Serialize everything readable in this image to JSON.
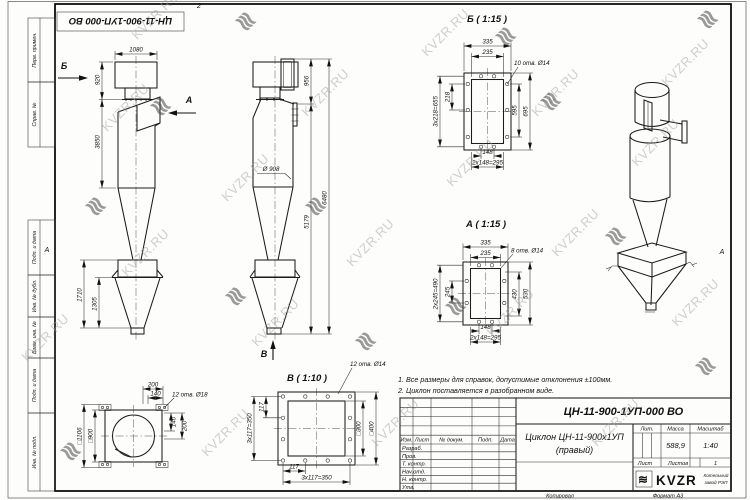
{
  "sheet": {
    "designation_rotated": "ЦН-11-900-1УП-000 ВО",
    "fold_top": "2",
    "fold_left": "А",
    "fold_right": "А",
    "margin_labels": [
      "Перв. примен.",
      "Справ. №",
      "Подп. и дата",
      "Инв. № дубл.",
      "Взам. инв. №",
      "Подп. и дата",
      "Инв. № подл."
    ]
  },
  "watermark": {
    "text": "KVZR.RU",
    "logo_glyph": "≋"
  },
  "views": {
    "side": {
      "arrow_b": "Б",
      "arrow_a": "А",
      "dim_top_width": "1080",
      "dim_outlet_h": "920",
      "dim_body_h": "3850",
      "dim_bottom_h": "1710",
      "dim_hopper_h": "1305"
    },
    "front": {
      "arrow_v": "В",
      "dim_inlet_h": "956",
      "dim_total_h": "6480",
      "dim_lower_h": "5179",
      "dim_diameter": "Ø 908"
    },
    "detail_b": {
      "title": "Б ( 1:15 )",
      "holes_note": "10 отв. Ø14",
      "dim_335": "335",
      "dim_235": "235",
      "dim_218": "218",
      "chain_left": "3х218=655",
      "dim_595": "595",
      "dim_695": "695",
      "dim_148": "148",
      "chain_bottom": "2х148=295"
    },
    "detail_a": {
      "title": "А ( 1:15 )",
      "holes_note": "8 отв. Ø14",
      "dim_335": "335",
      "dim_235": "235",
      "dim_245": "245",
      "chain_left": "2х245=490",
      "dim_430": "430",
      "dim_530": "530",
      "dim_148": "148",
      "chain_bottom": "2х148=295"
    },
    "detail_v": {
      "title": "В ( 1:10 )",
      "holes_note": "12 отв. Ø14",
      "dim_117_left": "117",
      "chain_left": "3х117=350",
      "dim_117_bottom": "117",
      "chain_bottom": "3х117=350",
      "dim_sq300": "□300",
      "dim_sq400": "□400"
    },
    "plan": {
      "holes_note": "12 отв. Ø18",
      "dim_200_top": "200",
      "dim_140_top": "140",
      "dim_sq1106": "□1106",
      "dim_sq900": "□900",
      "dim_140_right": "140",
      "dim_200_right": "200"
    }
  },
  "notes": {
    "line1": "1. Все размеры для справок, допустимые отклонения ±100мм.",
    "line2": "2. Циклон поставляется в разобранном виде."
  },
  "title_block": {
    "designation": "ЦН-11-900-1УП-000 ВО",
    "name_line1": "Циклон ЦН-11-900х1УП",
    "name_line2": "(правый)",
    "columns": {
      "izm": "Изм.",
      "list": "Лист",
      "doc": "№ докум.",
      "podp": "Подп.",
      "data": "Дата"
    },
    "rows": [
      "Разраб.",
      "Пров.",
      "Т. контр.",
      "Нач.отд.",
      "Н. контр.",
      "Утв."
    ],
    "lit_label": "Лит.",
    "mass_label": "Масса",
    "scale_label": "Масштаб",
    "mass_value": "588,9",
    "scale_value": "1:40",
    "sheet_label": "Лист",
    "sheets_label": "Листов",
    "sheets_value": "1",
    "logo_text": "KVZR",
    "logo_glyph": "≋",
    "logo_sub1": "Котельный",
    "logo_sub2": "завод РЭП",
    "copied": "Копировал",
    "format": "Формат А3"
  }
}
